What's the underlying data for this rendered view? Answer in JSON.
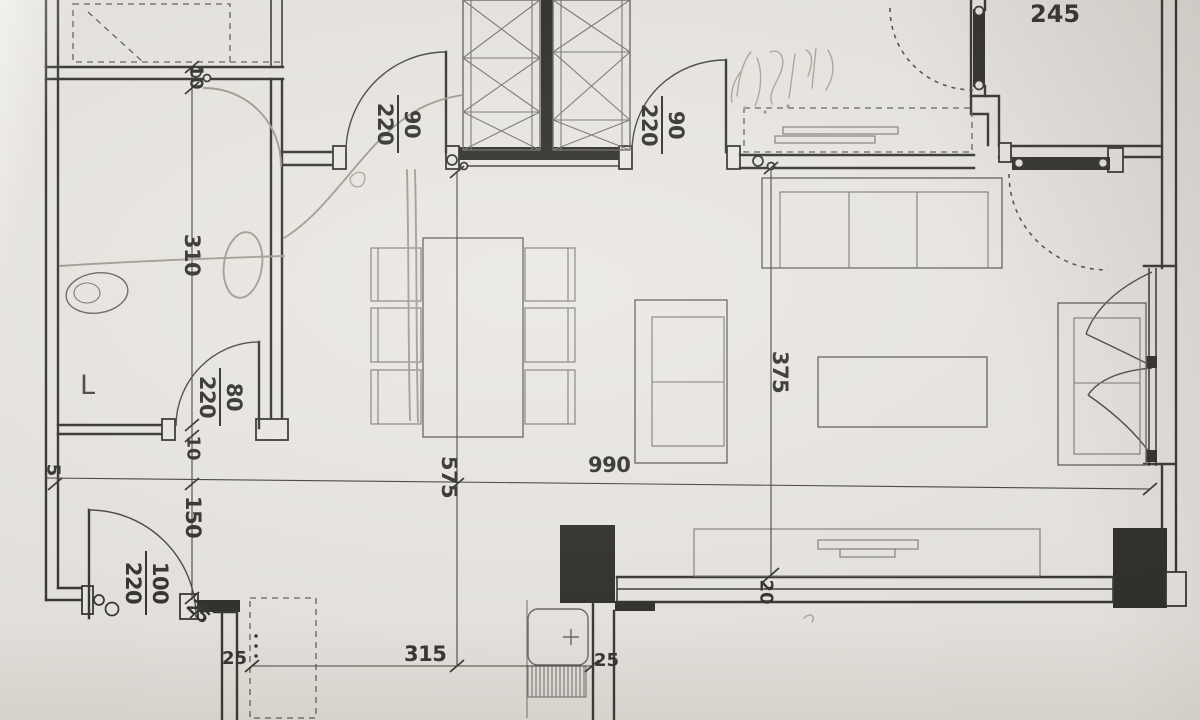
{
  "plan": {
    "labels": {
      "room_width_245": "245",
      "wc_depth_310": "310",
      "wall_thickness_top_10": "10",
      "wall_thickness_bottom_10": "10",
      "hall_length_150": "150",
      "wall_left_5": "5",
      "entry_wall_25": "25",
      "kitchen_wall_left_25": "25",
      "kitchen_width_315": "315",
      "kitchen_wall_right_25": "25",
      "living_width_990": "990",
      "dining_depth_575": "575",
      "living_depth_375": "375",
      "window_jamb_20": "20",
      "wc_letter": "L"
    },
    "doors": {
      "bedroom1": {
        "width": "90",
        "height": "220"
      },
      "bedroom2": {
        "width": "90",
        "height": "220"
      },
      "bathroom": {
        "width": "80",
        "height": "220"
      },
      "entry": {
        "width": "100",
        "height": "220"
      }
    }
  }
}
